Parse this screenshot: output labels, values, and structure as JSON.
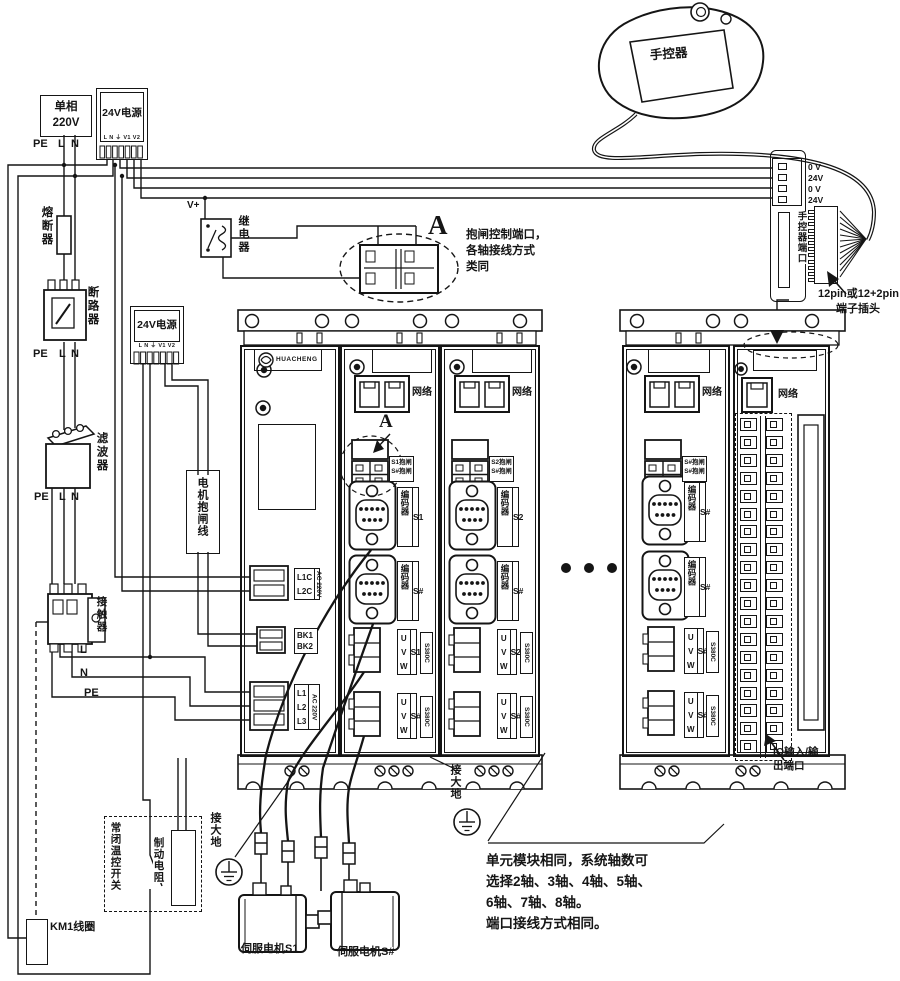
{
  "colors": {
    "ink": "#151515",
    "bg": "#ffffff"
  },
  "source": {
    "mains_line1": "单相",
    "mains_line2": "220V",
    "pe": "PE",
    "l": "L",
    "n": "N",
    "fuse": "熔断器",
    "breaker": "断路器",
    "filter": "滤波器",
    "contactor": "接触器",
    "out_l": "L",
    "out_n": "N",
    "out_pe": "PE",
    "psu_title": "24V电源",
    "psu_terminals": "L N ⏚ V1 V2",
    "relay": "继电器",
    "vplus": "V+",
    "brake_line": "电机抱闸线",
    "temp_switch": "常闭温控开关",
    "brake_resistor": "制动电阻",
    "km1_coil": "KM1线圈",
    "earth": "接大地"
  },
  "pendant": {
    "label": "手控器",
    "port_label": "手控器端口",
    "pin1": "0 V",
    "pin2": "24V",
    "pin3": "0 V",
    "pin4": "24V",
    "plug_note1": "12pin或12+2pin",
    "plug_note2": "端子插头"
  },
  "detail_a": {
    "letter": "A",
    "note1": "抱闸控制端口，",
    "note2": "各轴接线方式",
    "note3": "类同"
  },
  "modules": {
    "net": "网络",
    "enc": "编码器",
    "u": "U",
    "v": "V",
    "w": "W",
    "model": "S380C",
    "brand": "HUACHENG",
    "m1": {
      "c1a": "L1C",
      "c1b": "L2C",
      "c1side": "AC 220V",
      "c2a": "BK1",
      "c2b": "BK2",
      "c3a": "L1",
      "c3b": "L2",
      "c3c": "L3",
      "c3side": "AC 220V"
    },
    "m2": {
      "a": "A",
      "chip1": "S1抱闸",
      "chip2": "S#抱闸",
      "enc1": "S1",
      "enc2": "S#",
      "uvw1": "S1",
      "uvw2": "S#"
    },
    "m3": {
      "chip1": "S2抱闸",
      "chip2": "S#抱闸",
      "enc1": "S2",
      "enc2": "S#",
      "uvw1": "S2",
      "uvw2": "S#"
    },
    "m4": {
      "chip1": "S#抱闸",
      "chip2": "S#抱闸",
      "enc1": "S#",
      "enc2": "S#",
      "uvw1": "S#",
      "uvw2": "S#"
    },
    "io": {
      "note1": "IO输入/输",
      "note2": "出端口"
    }
  },
  "motors": {
    "m1": "伺服电机S1",
    "m2": "伺服电机S#"
  },
  "unit_note": {
    "l1": "单元模块相同，系统轴数可",
    "l2": "选择2轴、3轴、4轴、5轴、",
    "l3": "6轴、7轴、8轴。",
    "l4": "端口接线方式相同。"
  }
}
